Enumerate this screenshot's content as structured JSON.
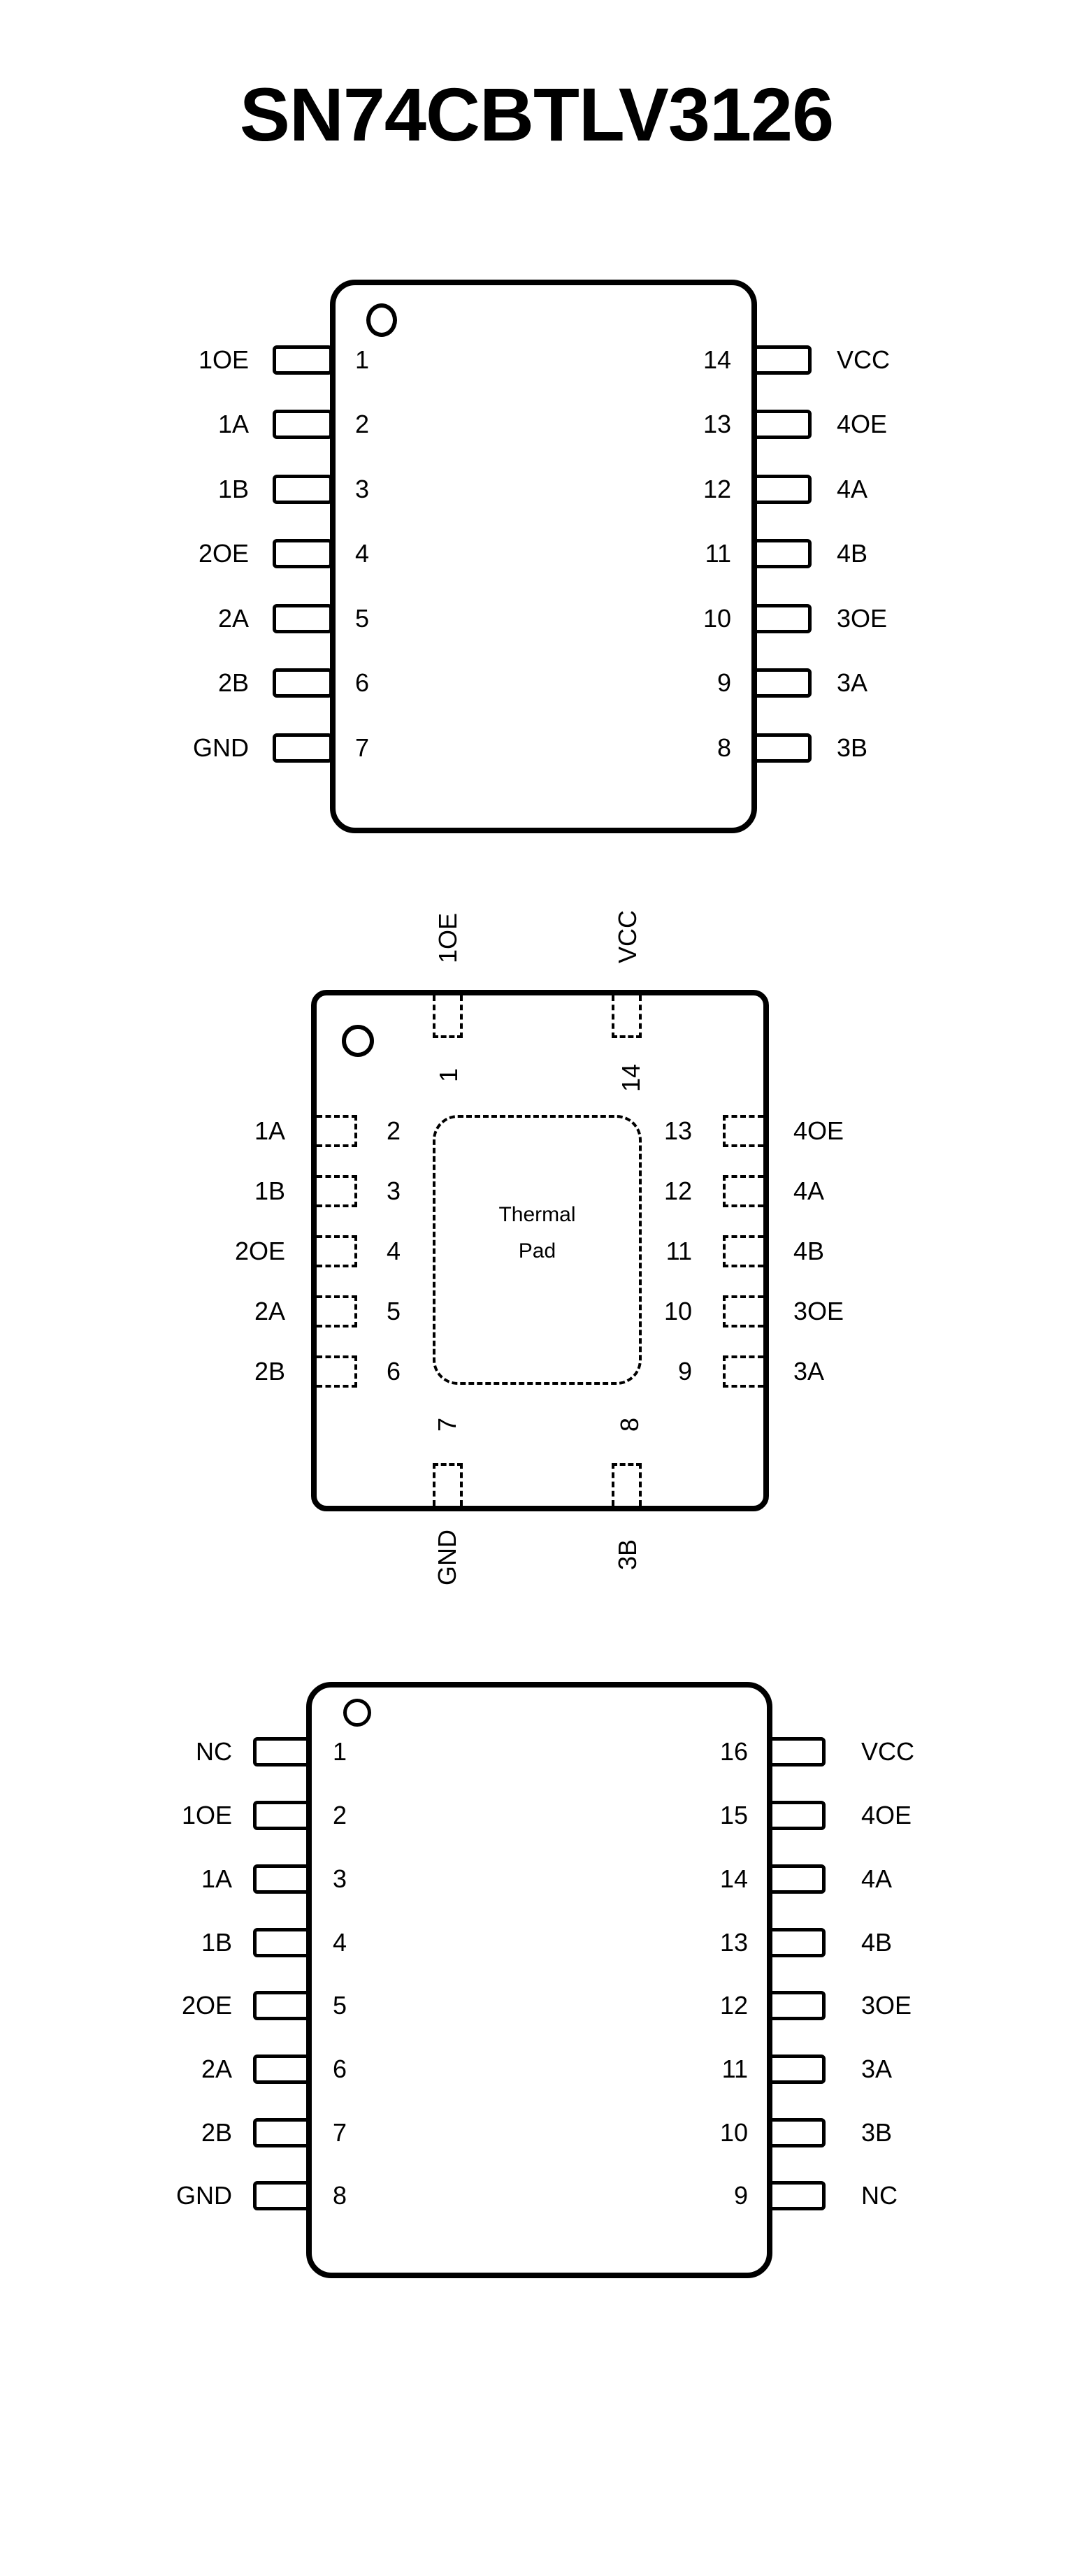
{
  "page": {
    "title": "SN74CBTLV3126"
  },
  "colors": {
    "ink": "#000000",
    "background": "#ffffff"
  },
  "icons": {
    "pin1_indicator": "circle-icon"
  },
  "pkg14": {
    "left": [
      {
        "label": "1OE",
        "num": "1"
      },
      {
        "label": "1A",
        "num": "2"
      },
      {
        "label": "1B",
        "num": "3"
      },
      {
        "label": "2OE",
        "num": "4"
      },
      {
        "label": "2A",
        "num": "5"
      },
      {
        "label": "2B",
        "num": "6"
      },
      {
        "label": "GND",
        "num": "7"
      }
    ],
    "right": [
      {
        "label": "VCC",
        "num": "14"
      },
      {
        "label": "4OE",
        "num": "13"
      },
      {
        "label": "4A",
        "num": "12"
      },
      {
        "label": "4B",
        "num": "11"
      },
      {
        "label": "3OE",
        "num": "10"
      },
      {
        "label": "3A",
        "num": "9"
      },
      {
        "label": "3B",
        "num": "8"
      }
    ]
  },
  "qfn": {
    "top": [
      {
        "label": "1OE",
        "num": "1"
      },
      {
        "label": "VCC",
        "num": "14"
      }
    ],
    "left": [
      {
        "label": "1A",
        "num": "2"
      },
      {
        "label": "1B",
        "num": "3"
      },
      {
        "label": "2OE",
        "num": "4"
      },
      {
        "label": "2A",
        "num": "5"
      },
      {
        "label": "2B",
        "num": "6"
      }
    ],
    "right": [
      {
        "label": "4OE",
        "num": "13"
      },
      {
        "label": "4A",
        "num": "12"
      },
      {
        "label": "4B",
        "num": "11"
      },
      {
        "label": "3OE",
        "num": "10"
      },
      {
        "label": "3A",
        "num": "9"
      }
    ],
    "bottom": [
      {
        "label": "GND",
        "num": "7"
      },
      {
        "label": "3B",
        "num": "8"
      }
    ],
    "thermal_pad_line1": "Thermal",
    "thermal_pad_line2": "Pad"
  },
  "pkg16": {
    "left": [
      {
        "label": "NC",
        "num": "1"
      },
      {
        "label": "1OE",
        "num": "2"
      },
      {
        "label": "1A",
        "num": "3"
      },
      {
        "label": "1B",
        "num": "4"
      },
      {
        "label": "2OE",
        "num": "5"
      },
      {
        "label": "2A",
        "num": "6"
      },
      {
        "label": "2B",
        "num": "7"
      },
      {
        "label": "GND",
        "num": "8"
      }
    ],
    "right": [
      {
        "label": "VCC",
        "num": "16"
      },
      {
        "label": "4OE",
        "num": "15"
      },
      {
        "label": "4A",
        "num": "14"
      },
      {
        "label": "4B",
        "num": "13"
      },
      {
        "label": "3OE",
        "num": "12"
      },
      {
        "label": "3A",
        "num": "11"
      },
      {
        "label": "3B",
        "num": "10"
      },
      {
        "label": "NC",
        "num": "9"
      }
    ]
  }
}
